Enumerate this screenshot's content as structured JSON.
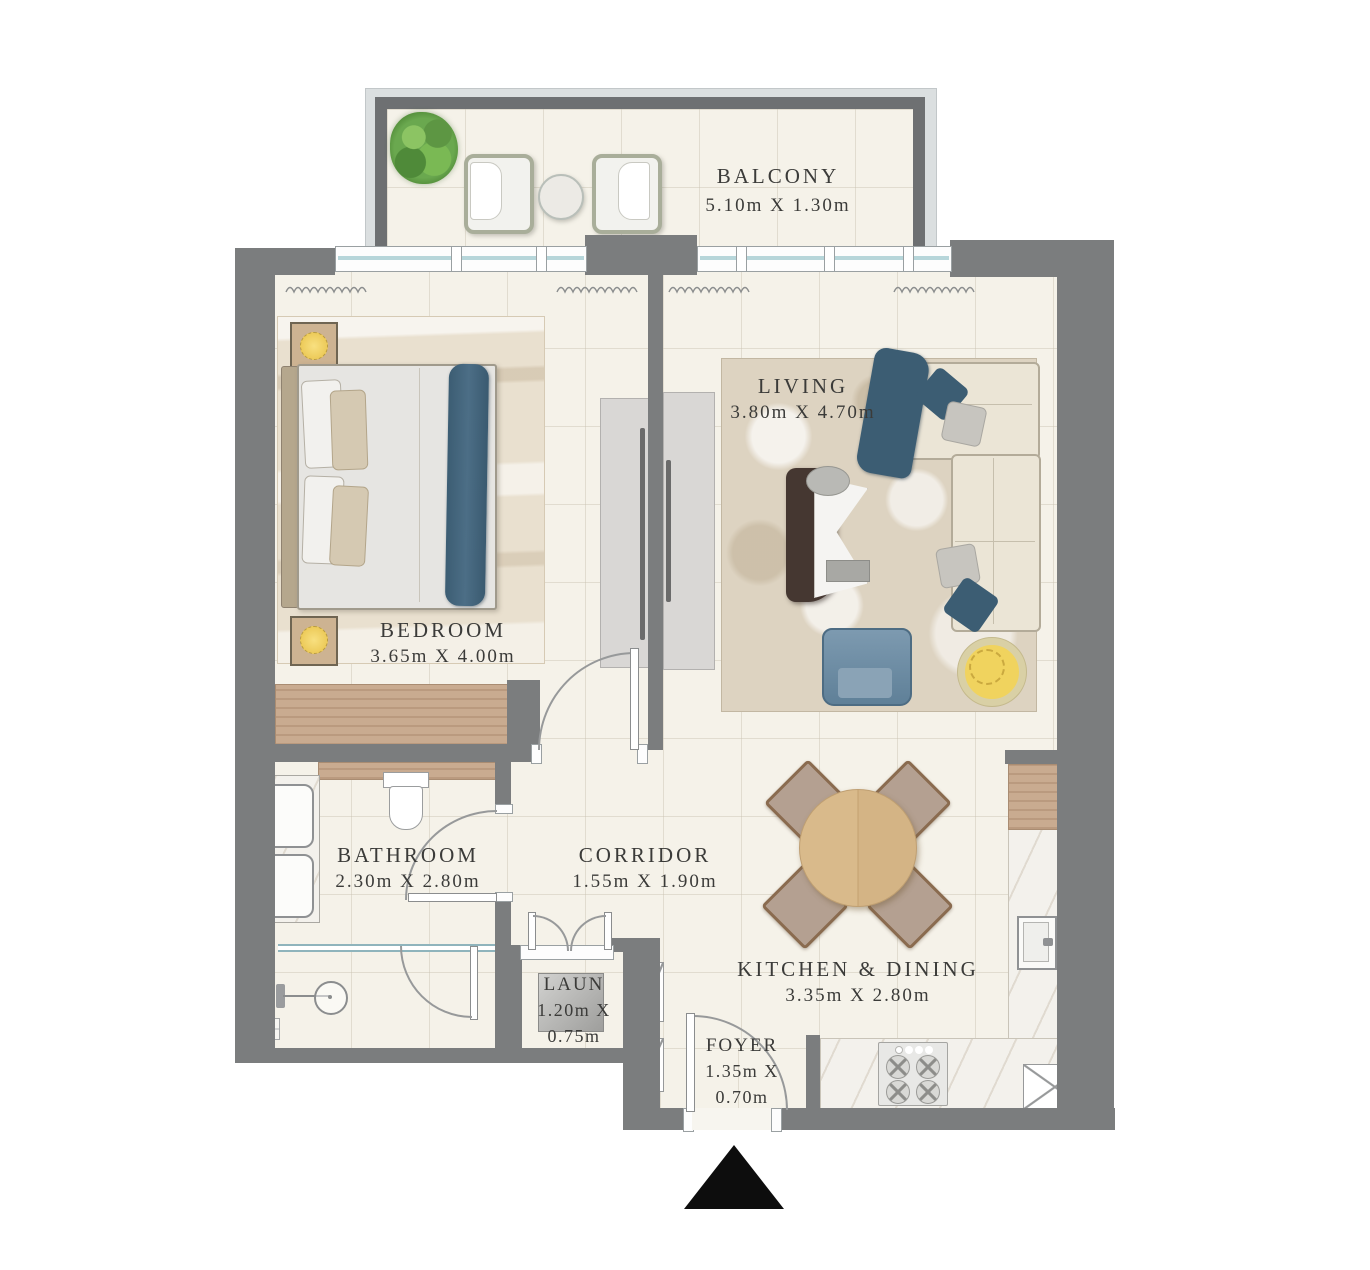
{
  "rooms": {
    "balcony": {
      "name": "BALCONY",
      "dims": "5.10m X 1.30m"
    },
    "bedroom": {
      "name": "BEDROOM",
      "dims": "3.65m X 4.00m"
    },
    "living": {
      "name": "LIVING",
      "dims": "3.80m X 4.70m"
    },
    "bathroom": {
      "name": "BATHROOM",
      "dims": "2.30m X 2.80m"
    },
    "corridor": {
      "name": "CORRIDOR",
      "dims": "1.55m X 1.90m"
    },
    "kitchen": {
      "name": "KITCHEN & DINING",
      "dims": "3.35m X 2.80m"
    },
    "laundry": {
      "name": "LAUN",
      "dims_line1": "1.20m X",
      "dims_line2": "0.75m"
    },
    "foyer": {
      "name": "FOYER",
      "dims_line1": "1.35m X",
      "dims_line2": "0.70m"
    }
  },
  "colors": {
    "wall": "#7b7d7e",
    "balcony_wall": "#6e7072",
    "floor": "#f5f2e9",
    "window_glass": "#b7d6da",
    "wood": "#c9ab90",
    "marble": "#f3f1ec",
    "bedroom_rug": "#e9e0cf",
    "living_rug": "#ddd3c1",
    "sofa_cream": "#ebe5d6",
    "accent_blue": "#3f5f75",
    "armchair_blue": "#6d8ba3",
    "lamp_yellow": "#f0d35e",
    "table_wood": "#d8b989",
    "chair_seat": "#b4a091",
    "plant_green": "#6aa84f",
    "coffee_table_brown": "#453731",
    "label_text": "#3b3b39",
    "entrance_marker": "#0d0d0d"
  },
  "markers": {
    "entrance": {
      "type": "triangle",
      "color": "#0d0d0d"
    }
  }
}
